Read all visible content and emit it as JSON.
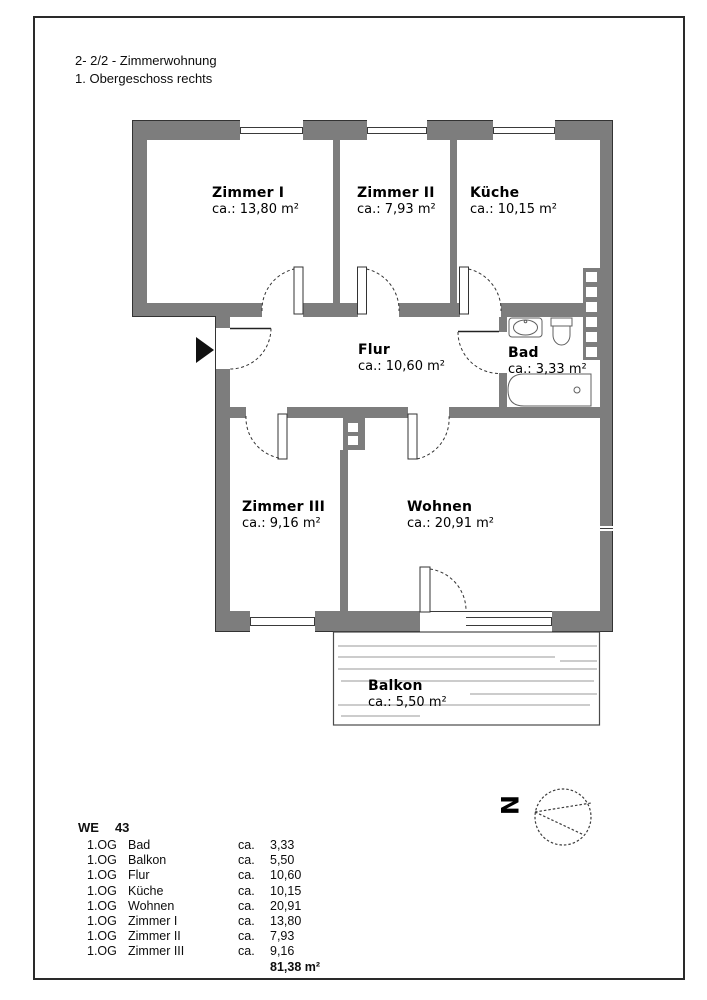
{
  "header": {
    "line1": "2- 2/2 - Zimmerwohnung",
    "line2": "1. Obergeschoss rechts"
  },
  "rooms": {
    "zimmer1": {
      "name": "Zimmer I",
      "area": "ca.: 13,80 m²"
    },
    "zimmer2": {
      "name": "Zimmer II",
      "area": "ca.: 7,93 m²"
    },
    "kueche": {
      "name": "Küche",
      "area": "ca.: 10,15 m²"
    },
    "flur": {
      "name": "Flur",
      "area": "ca.: 10,60 m²"
    },
    "bad": {
      "name": "Bad",
      "area": "ca.: 3,33 m²"
    },
    "zimmer3": {
      "name": "Zimmer III",
      "area": "ca.: 9,16 m²"
    },
    "wohnen": {
      "name": "Wohnen",
      "area": "ca.: 20,91 m²"
    },
    "balkon": {
      "name": "Balkon",
      "area": "ca.: 5,50 m²"
    }
  },
  "compass": {
    "north": "N"
  },
  "summary": {
    "we_label": "WE",
    "we_number": "43",
    "rows": [
      {
        "floor": "1.OG",
        "room": "Bad",
        "ca": "ca.",
        "value": "3,33"
      },
      {
        "floor": "1.OG",
        "room": "Balkon",
        "ca": "ca.",
        "value": "5,50"
      },
      {
        "floor": "1.OG",
        "room": "Flur",
        "ca": "ca.",
        "value": "10,60"
      },
      {
        "floor": "1.OG",
        "room": "Küche",
        "ca": "ca.",
        "value": "10,15"
      },
      {
        "floor": "1.OG",
        "room": "Wohnen",
        "ca": "ca.",
        "value": "20,91"
      },
      {
        "floor": "1.OG",
        "room": "Zimmer I",
        "ca": "ca.",
        "value": "13,80"
      },
      {
        "floor": "1.OG",
        "room": "Zimmer II",
        "ca": "ca.",
        "value": "7,93"
      },
      {
        "floor": "1.OG",
        "room": "Zimmer III",
        "ca": "ca.",
        "value": "9,16"
      }
    ],
    "total": "81,38 m²"
  },
  "colors": {
    "wall": "#7d7d7d",
    "line": "#333333"
  }
}
